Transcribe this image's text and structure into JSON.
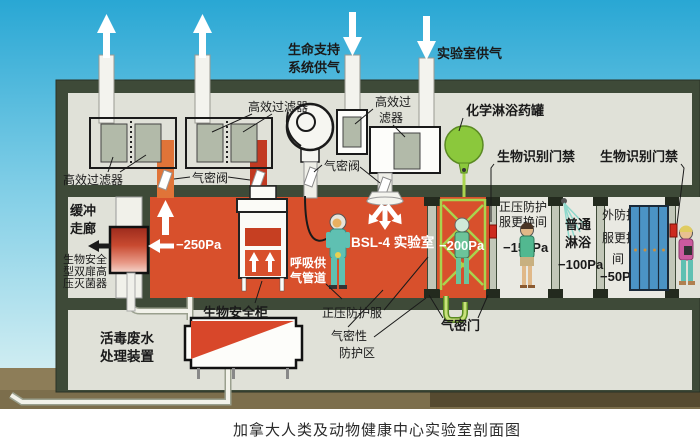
{
  "caption": "加拿大人类及动物健康中心实验室剖面图",
  "colors": {
    "sky_top": "#29a7d4",
    "sky_bottom": "#dff3f4",
    "wall_dark": "#3e4a38",
    "interior_grey": "#e0e1d8",
    "lab_red": "#d8502c",
    "duct_orange": "#e07438",
    "duct_red": "#c23a22",
    "filter_grey": "#b2baa9",
    "tank_green": "#8bc83c",
    "pipe_green": "#a9d44e",
    "suit_teal": "#5fc0b2",
    "locker_blue": "#4b93c5",
    "ground_brown": "#8d7d58",
    "access_device_red": "#cc2a1e"
  },
  "labels": {
    "supply_life": [
      "生命支持",
      "系统供气"
    ],
    "supply_lab": "实验室供气",
    "hepa_left": "高效过滤器",
    "hepa_top": "高效过滤器",
    "hepa_mid": [
      "高效过",
      "滤器"
    ],
    "valve_left": "气密阀",
    "valve_mid": "气密阀",
    "chem_tank": "化学淋浴药罐",
    "bio_access_left": "生物识别门禁",
    "bio_access_right": "生物识别门禁",
    "buffer": [
      "缓冲",
      "走廊"
    ],
    "autoclave": [
      "生物安全",
      "型双扉高",
      "压灭菌器"
    ],
    "cabinet": "生物安全柜",
    "breathing": [
      "呼吸供",
      "气管道"
    ],
    "bsl4_room": "BSL-4 实验室",
    "pressure_suit": "正压防护服",
    "airtight_zone": [
      "气密性",
      "防护区"
    ],
    "airtight_door": "气密门",
    "wastewater": [
      "活毒废水",
      "处理装置"
    ],
    "suit_change_room": [
      "正压防护",
      "服更换间"
    ],
    "plain_shower": [
      "普通",
      "淋浴"
    ],
    "outer_change_room": [
      "外防护",
      "服更换",
      "间"
    ]
  },
  "pressures": {
    "bsl4_lab": "−250Pa",
    "chem_shower": "−200Pa",
    "suit_change": "−150Pa",
    "plain_shower": "−100Pa",
    "outer_change": "−50Pa"
  }
}
